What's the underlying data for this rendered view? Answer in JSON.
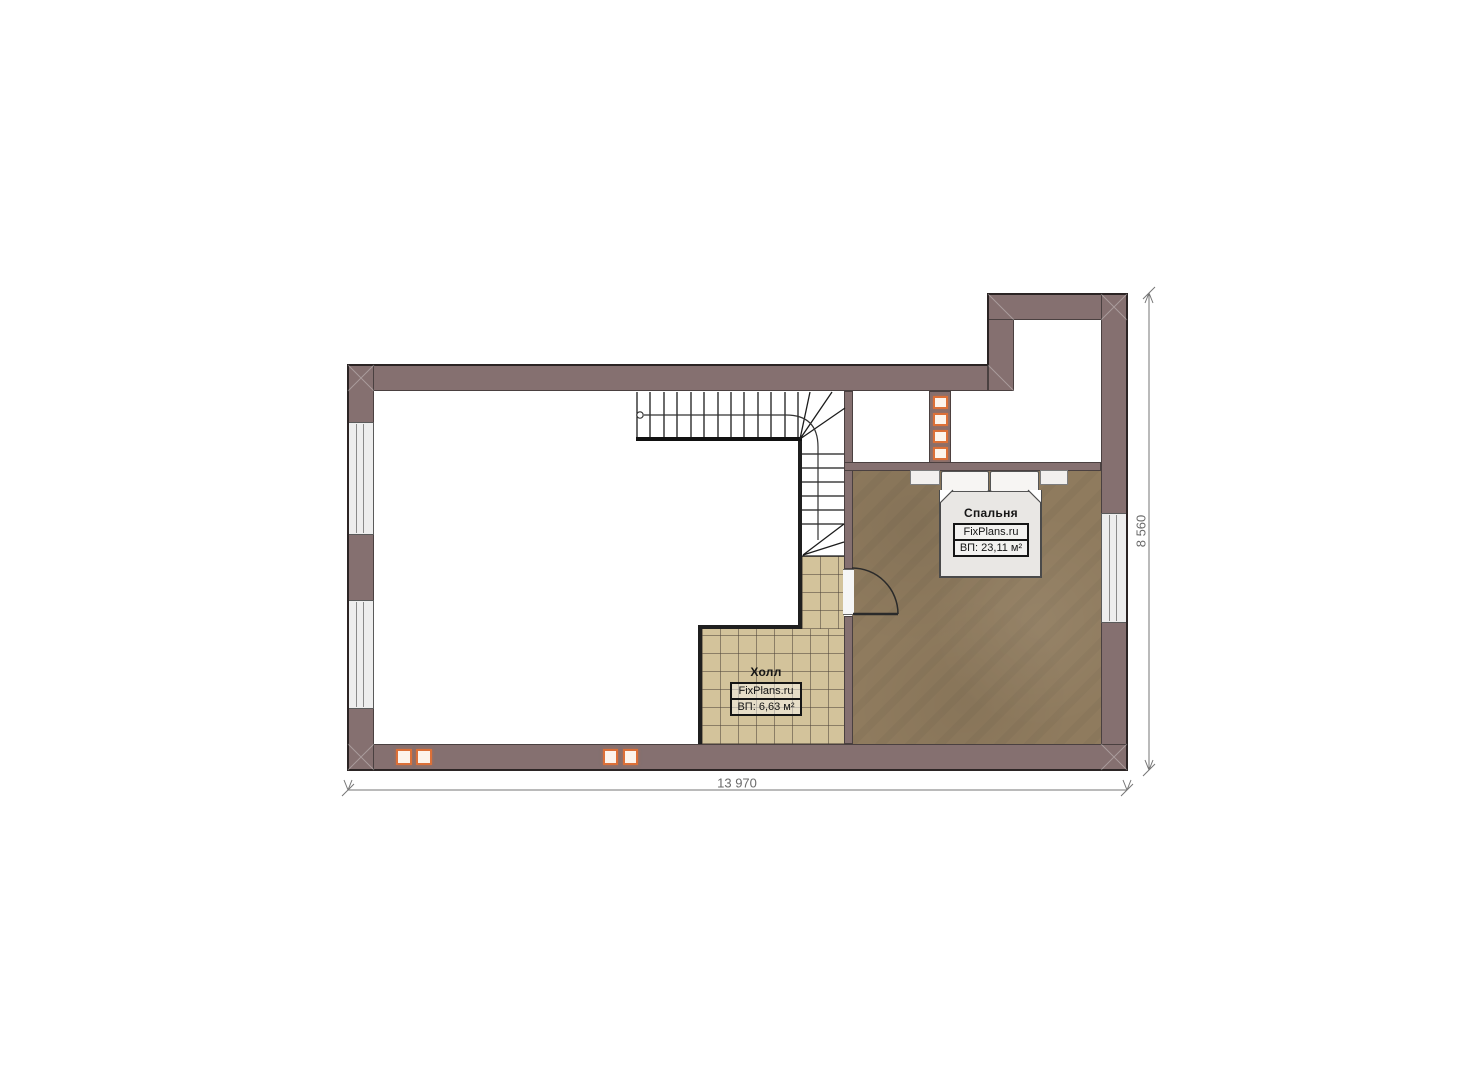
{
  "plan": {
    "rooms": {
      "bedroom": {
        "name": "Спальня",
        "brand": "FixPlans.ru",
        "area": "ВП: 23,11 м²"
      },
      "hall": {
        "name": "Холл",
        "brand": "FixPlans.ru",
        "area": "ВП: 6,63 м²"
      }
    },
    "dimensions": {
      "width": "13 970",
      "height": "8 560"
    }
  },
  "colors": {
    "wall": "#857070",
    "wall_edge": "#4a4040",
    "bedroom_floor": "#8f7b5e",
    "hall_floor": "#d3c39b",
    "hall_grid": "#6f655a",
    "accent": "#dc7038",
    "line": "#1f1f1f",
    "dim": "#6a6a6a",
    "furniture": "#e9e7e4",
    "window_fill": "#ededed"
  }
}
